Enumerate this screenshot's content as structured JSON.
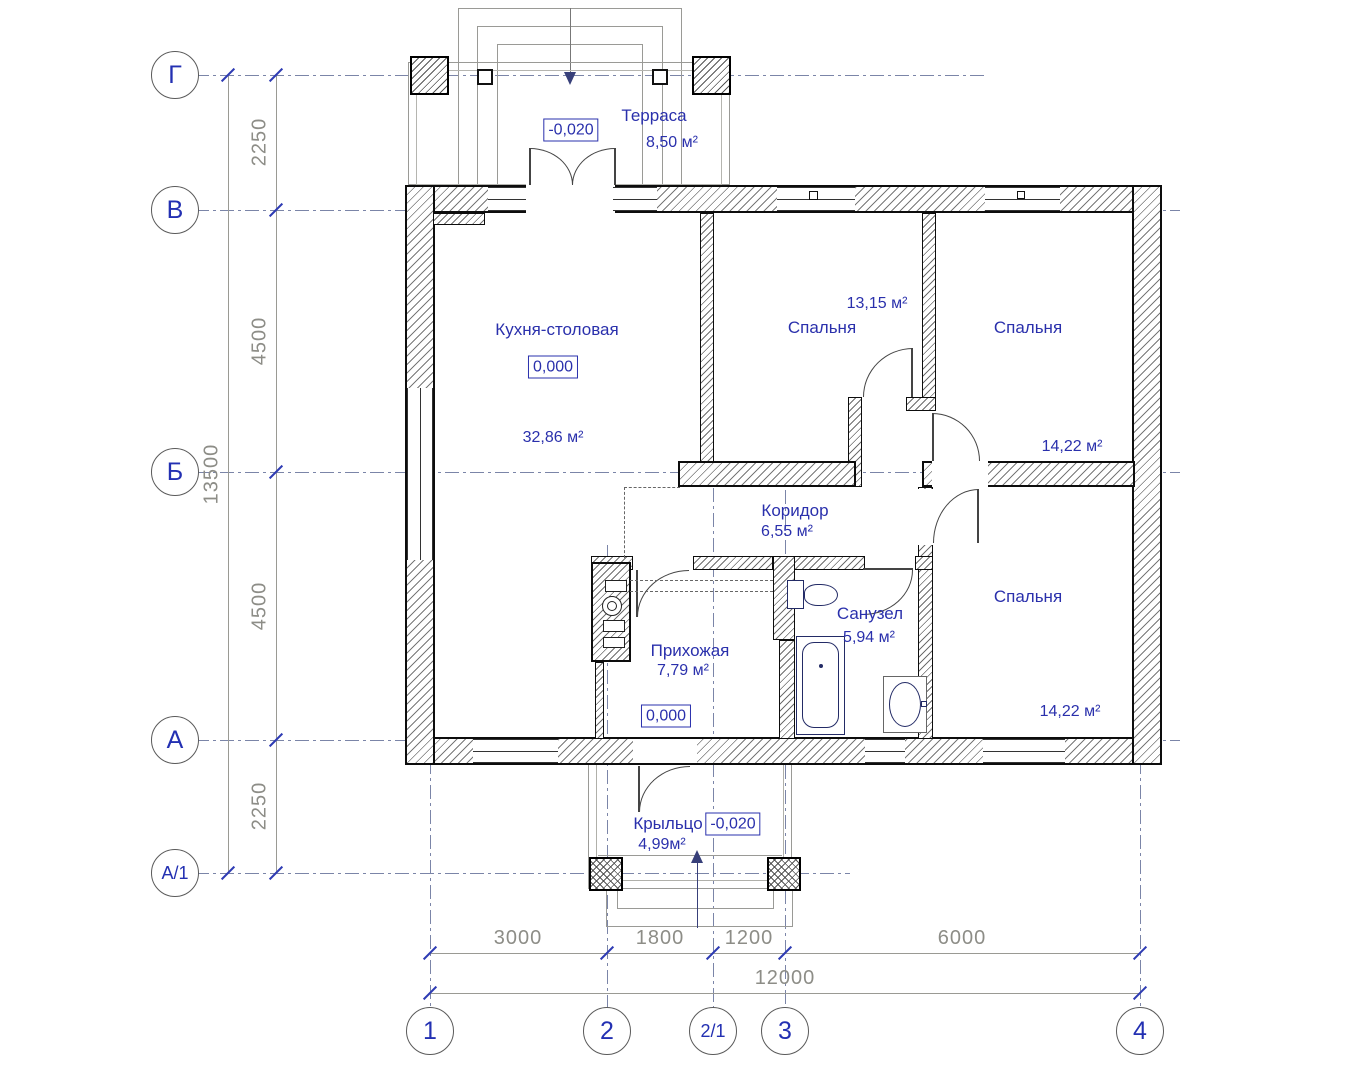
{
  "drawing": {
    "type": "floor-plan",
    "units": "mm",
    "rooms": [
      {
        "id": "terrace",
        "name": "Терраса",
        "area": "8,50 м²"
      },
      {
        "id": "kitchen",
        "name": "Кухня-столовая",
        "area": "32,86 м²"
      },
      {
        "id": "bedroom1",
        "name": "Спальня",
        "area": "13,15 м²"
      },
      {
        "id": "bedroom2",
        "name": "Спальня",
        "area": "14,22 м²"
      },
      {
        "id": "corridor",
        "name": "Коридор",
        "area": "6,55 м²"
      },
      {
        "id": "bathroom",
        "name": "Санузел",
        "area": "5,94 м²"
      },
      {
        "id": "hall",
        "name": "Прихожая",
        "area": "7,79 м²"
      },
      {
        "id": "bedroom3",
        "name": "Спальня",
        "area": "14,22 м²"
      },
      {
        "id": "porch",
        "name": "Крыльцо",
        "area": "4,99м²"
      }
    ],
    "elevations": {
      "terrace": "-0,020",
      "kitchen": "0,000",
      "hall": "0,000",
      "porch": "-0,020"
    },
    "axes": {
      "horizontal": [
        "Г",
        "В",
        "Б",
        "А",
        "А/1"
      ],
      "vertical": [
        "1",
        "2",
        "2/1",
        "3",
        "4"
      ]
    },
    "dimensions": {
      "left_segments": [
        "2250",
        "4500",
        "4500",
        "2250"
      ],
      "left_total": "13500",
      "bottom_segments": [
        "3000",
        "1800",
        "1200",
        "6000"
      ],
      "bottom_total": "12000"
    },
    "colors": {
      "label_blue": "#2a30ac",
      "tick_blue": "#2e3bb3",
      "dim_gray": "#8d8d87",
      "wall_line": "#0d0d0d"
    }
  }
}
